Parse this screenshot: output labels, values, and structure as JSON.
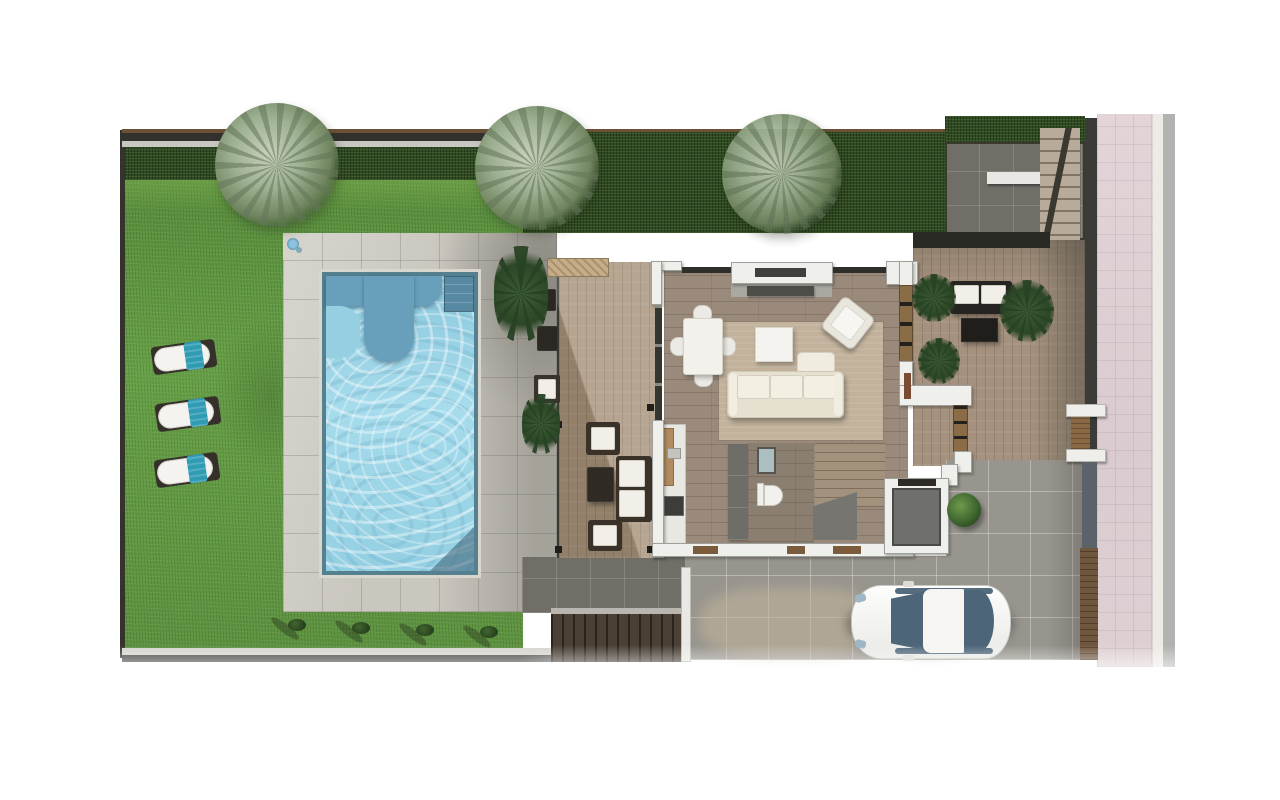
{
  "meta": {
    "type": "architectural-floor-plan-rendering",
    "view": "top-down",
    "visible_text": "none",
    "scene": "villa ground floor with garden, pool, deck, entrance terrace, driveway and street sidewalk"
  },
  "palette": {
    "page_bg": "#ffffff",
    "lawn_green": "#629544",
    "lawn_light": "#7cac50",
    "hedge_green": "#2f4a22",
    "boundary_brown": "#6b5138",
    "boundary_dark": "#33322e",
    "boundary_light": "#c9c7c1",
    "pool_paving": "#cac7bf",
    "paving_shadow": "#6f6d67",
    "pool_rim": "#55808f",
    "pool_water": "#9dd3e6",
    "pool_bench": "#68a0bb",
    "deck_wood": "#a8947c",
    "stone_bench": "#c6ad89",
    "interior_wood": "#9a8a7b",
    "rug_beige": "#c2b29c",
    "wall_white": "#efefec",
    "glass_dark": "#35352f",
    "window_wood": "#8a6c46",
    "bathroom_floor": "#8b7f71",
    "kitchen_cabinet_gray": "#6e6d68",
    "stair_wood": "#a2917c",
    "terrace_wood": "#a5927e",
    "planter_dark": "#2a2a25",
    "court_gray": "#716e68",
    "driveway_gray": "#98958e",
    "sand_patch": "#bdb3a0",
    "sidewalk_pink": "#dccfd2",
    "curb_white": "#edebe5",
    "street_gray": "#b2b2b0",
    "pedestrian_gate_brown": "#8a6844",
    "driveway_gate_brown": "#6f563d",
    "gate_gray": "#5c6269",
    "towel_teal": "#2f9cb4",
    "furniture_white": "#f1efe8",
    "furniture_dark": "#2b2722",
    "car_body_white": "#f4f4f2",
    "car_glass_blue": "#4d6579",
    "tree_olive": "#9db092",
    "palm_dark": "#2e4a28"
  },
  "garden": {
    "lawn": true,
    "perimeter_hedge": true,
    "trees": [
      "olive-tree-left",
      "olive-tree-center",
      "palm-tree-over-hedge"
    ],
    "sun_loungers": [
      {
        "id": 1,
        "cushion": "white",
        "towel": "teal"
      },
      {
        "id": 2,
        "cushion": "white",
        "towel": "teal"
      },
      {
        "id": 3,
        "cushion": "white",
        "towel": "teal"
      }
    ],
    "bottom_bushes": 4,
    "outdoor_shower": true
  },
  "pool": {
    "shape": "rectangular",
    "features": [
      "submerged-bench",
      "corner-step"
    ],
    "surround": "stone-paving-with-tile-joints"
  },
  "deck": {
    "material": "wood",
    "stone_bench_top": true,
    "furniture": [
      "armchair",
      "coffee-table",
      "two-seat-sofa",
      "armchair"
    ],
    "poolside_chairs": [
      "dark-chair",
      "dark-chair",
      "white-cushion-chair"
    ]
  },
  "house": {
    "rooms": [
      "living-dining-room",
      "kitchen",
      "bathroom",
      "staircase",
      "storage-room"
    ],
    "living_room": [
      "dining-table-with-4-chairs",
      "coffee-table",
      "armchair",
      "l-shaped-sofa",
      "tv-console",
      "area-rug",
      "picture-window"
    ],
    "kitchen": [
      "counter-run",
      "cutting-board",
      "oven",
      "tall-units"
    ],
    "bathroom": [
      "shower",
      "toilet",
      "gray-vanity-wall"
    ],
    "staircase": [
      "wood-treads",
      "dark-landing"
    ],
    "storage_room": [
      "gray-floor"
    ]
  },
  "entrance_terrace": {
    "floor": "wood-plank-tiles",
    "furniture": [
      "outdoor-sofa-white-cushions",
      "dark-coffee-table"
    ],
    "plants": 3,
    "planter_band_top": true,
    "exterior_stairs_top_right": true,
    "dark_court_top": true
  },
  "driveway": {
    "car": {
      "type": "sedan",
      "body": "white",
      "glass": "blue-gray"
    },
    "round_bush": 1,
    "lower_exit_stairs": true
  },
  "boundary": {
    "right_wall": "dark",
    "pedestrian_gate": {
      "pillars": "white",
      "door": "brown"
    },
    "driveway_gate": "brown",
    "sidewalk": "pink-tiles",
    "street_strip": "gray"
  }
}
